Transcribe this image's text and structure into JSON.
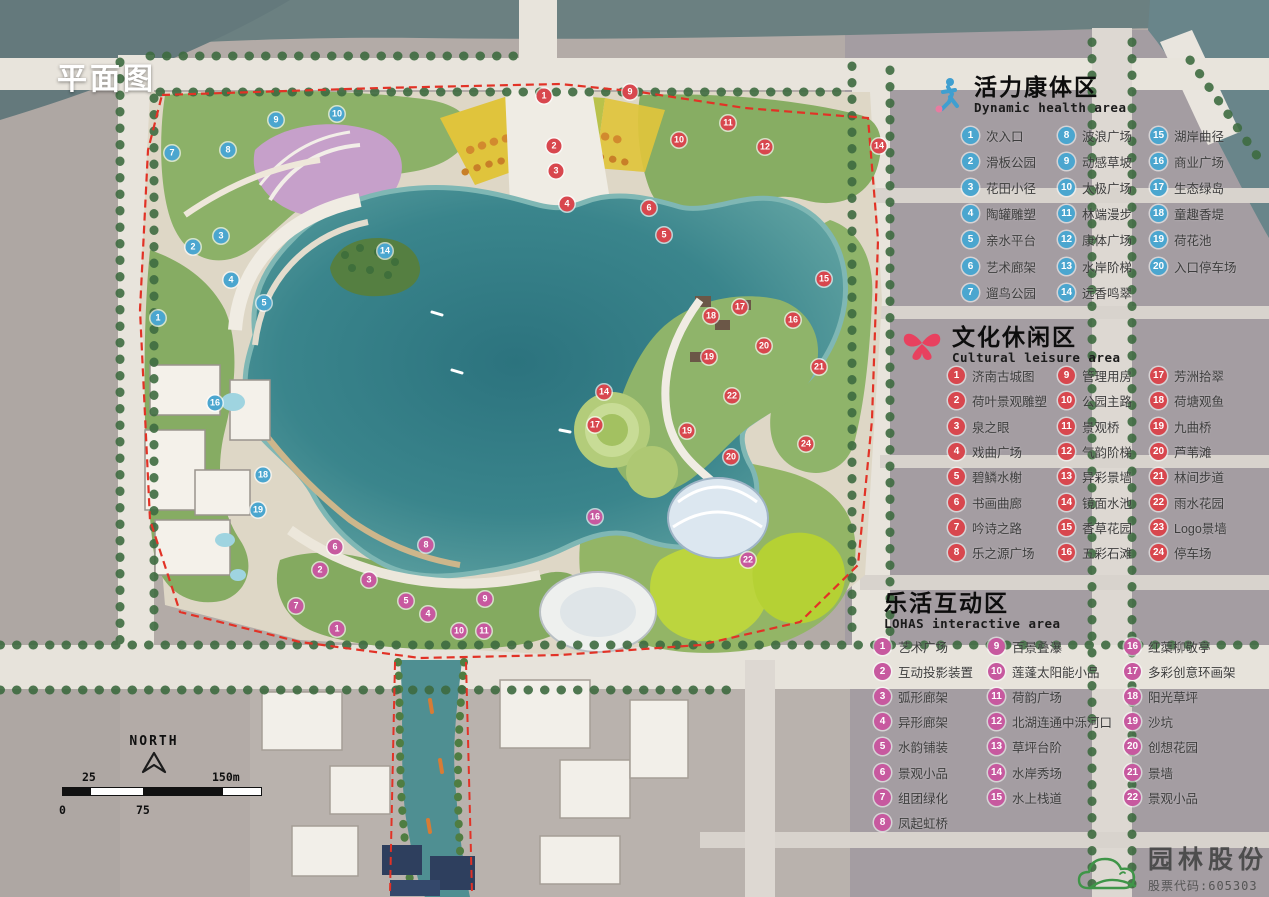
{
  "title": "平面图",
  "north_label": "NORTH",
  "scale_bar": {
    "top_labels": [
      "25",
      "150m"
    ],
    "bottom_labels": [
      "0",
      "75"
    ]
  },
  "logo": {
    "company": "园林股份",
    "ticker": "股票代码:605303",
    "icon": "cloud-hill-logo-icon",
    "color": "#3f9548"
  },
  "zones": [
    {
      "id": "dynamic",
      "cn": "活力康体区",
      "en": "Dynamic health area",
      "icon": "runner-icon",
      "badge_color": "#4ba6cf",
      "columns": [
        [
          {
            "n": "1",
            "t": "次入口"
          },
          {
            "n": "2",
            "t": "滑板公园"
          },
          {
            "n": "3",
            "t": "花田小径"
          },
          {
            "n": "4",
            "t": "陶罐雕塑"
          },
          {
            "n": "5",
            "t": "亲水平台"
          },
          {
            "n": "6",
            "t": "艺术廊架"
          },
          {
            "n": "7",
            "t": "遛鸟公园"
          }
        ],
        [
          {
            "n": "8",
            "t": "波浪广场"
          },
          {
            "n": "9",
            "t": "动感草坡"
          },
          {
            "n": "10",
            "t": "太极广场"
          },
          {
            "n": "11",
            "t": "林端漫步"
          },
          {
            "n": "12",
            "t": "康体广场"
          },
          {
            "n": "13",
            "t": "水岸阶梯"
          },
          {
            "n": "14",
            "t": "远香鸣翠"
          }
        ],
        [
          {
            "n": "15",
            "t": "湖岸曲径"
          },
          {
            "n": "16",
            "t": "商业广场"
          },
          {
            "n": "17",
            "t": "生态绿岛"
          },
          {
            "n": "18",
            "t": "童趣香堤"
          },
          {
            "n": "19",
            "t": "荷花池"
          },
          {
            "n": "20",
            "t": "入口停车场"
          }
        ]
      ]
    },
    {
      "id": "cultural",
      "cn": "文化休闲区",
      "en": "Cultural leisure area",
      "icon": "butterfly-icon",
      "badge_color": "#d8474e",
      "columns": [
        [
          {
            "n": "1",
            "t": "济南古城图"
          },
          {
            "n": "2",
            "t": "荷叶景观雕塑"
          },
          {
            "n": "3",
            "t": "泉之眼"
          },
          {
            "n": "4",
            "t": "戏曲广场"
          },
          {
            "n": "5",
            "t": "碧鳞水榭"
          },
          {
            "n": "6",
            "t": "书画曲廊"
          },
          {
            "n": "7",
            "t": "吟诗之路"
          },
          {
            "n": "8",
            "t": "乐之源广场"
          }
        ],
        [
          {
            "n": "9",
            "t": "管理用房"
          },
          {
            "n": "10",
            "t": "公园主路"
          },
          {
            "n": "11",
            "t": "景观桥"
          },
          {
            "n": "12",
            "t": "气韵阶梯"
          },
          {
            "n": "13",
            "t": "异彩景墙"
          },
          {
            "n": "14",
            "t": "镜面水池"
          },
          {
            "n": "15",
            "t": "香草花园"
          },
          {
            "n": "16",
            "t": "五彩石滩"
          }
        ],
        [
          {
            "n": "17",
            "t": "芳洲拾翠"
          },
          {
            "n": "18",
            "t": "荷塘观鱼"
          },
          {
            "n": "19",
            "t": "九曲桥"
          },
          {
            "n": "20",
            "t": "芦苇滩"
          },
          {
            "n": "21",
            "t": "林间步道"
          },
          {
            "n": "22",
            "t": "雨水花园"
          },
          {
            "n": "23",
            "t": "Logo景墙"
          },
          {
            "n": "24",
            "t": "停车场"
          }
        ]
      ]
    },
    {
      "id": "lohas",
      "cn": "乐活互动区",
      "en": "LOHAS interactive area",
      "icon": "crescent-moon-icon",
      "badge_color": "#c7599f",
      "columns": [
        [
          {
            "n": "1",
            "t": "艺术广场"
          },
          {
            "n": "2",
            "t": "互动投影装置"
          },
          {
            "n": "3",
            "t": "弧形廊架"
          },
          {
            "n": "4",
            "t": "异形廊架"
          },
          {
            "n": "5",
            "t": "水韵铺装"
          },
          {
            "n": "6",
            "t": "景观小品"
          },
          {
            "n": "7",
            "t": "组团绿化"
          },
          {
            "n": "8",
            "t": "凤起虹桥"
          }
        ],
        [
          {
            "n": "9",
            "t": "百景叠瀑"
          },
          {
            "n": "10",
            "t": "莲蓬太阳能小品"
          },
          {
            "n": "11",
            "t": "荷韵广场"
          },
          {
            "n": "12",
            "t": "北湖连通中泺河口"
          },
          {
            "n": "13",
            "t": "草坪台阶"
          },
          {
            "n": "14",
            "t": "水岸秀场"
          },
          {
            "n": "15",
            "t": "水上栈道"
          }
        ],
        [
          {
            "n": "16",
            "t": "红蕖柳敬亭"
          },
          {
            "n": "17",
            "t": "多彩创意环画架"
          },
          {
            "n": "18",
            "t": "阳光草坪"
          },
          {
            "n": "19",
            "t": "沙坑"
          },
          {
            "n": "20",
            "t": "创想花园"
          },
          {
            "n": "21",
            "t": "景墙"
          },
          {
            "n": "22",
            "t": "景观小品"
          }
        ]
      ]
    }
  ],
  "map_markers": [
    {
      "zone": "dynamic",
      "n": "1",
      "x": 158,
      "y": 318
    },
    {
      "zone": "dynamic",
      "n": "2",
      "x": 193,
      "y": 247
    },
    {
      "zone": "dynamic",
      "n": "3",
      "x": 221,
      "y": 236
    },
    {
      "zone": "dynamic",
      "n": "4",
      "x": 231,
      "y": 280
    },
    {
      "zone": "dynamic",
      "n": "5",
      "x": 264,
      "y": 303
    },
    {
      "zone": "dynamic",
      "n": "7",
      "x": 172,
      "y": 153
    },
    {
      "zone": "dynamic",
      "n": "8",
      "x": 228,
      "y": 150
    },
    {
      "zone": "dynamic",
      "n": "9",
      "x": 276,
      "y": 120
    },
    {
      "zone": "dynamic",
      "n": "10",
      "x": 337,
      "y": 114
    },
    {
      "zone": "dynamic",
      "n": "14",
      "x": 385,
      "y": 251
    },
    {
      "zone": "dynamic",
      "n": "16",
      "x": 215,
      "y": 403
    },
    {
      "zone": "dynamic",
      "n": "18",
      "x": 263,
      "y": 475
    },
    {
      "zone": "dynamic",
      "n": "19",
      "x": 258,
      "y": 510
    },
    {
      "zone": "cultural",
      "n": "1",
      "x": 544,
      "y": 96
    },
    {
      "zone": "cultural",
      "n": "2",
      "x": 554,
      "y": 146
    },
    {
      "zone": "cultural",
      "n": "3",
      "x": 556,
      "y": 171
    },
    {
      "zone": "cultural",
      "n": "4",
      "x": 567,
      "y": 204
    },
    {
      "zone": "cultural",
      "n": "5",
      "x": 664,
      "y": 235
    },
    {
      "zone": "cultural",
      "n": "6",
      "x": 649,
      "y": 208
    },
    {
      "zone": "cultural",
      "n": "9",
      "x": 630,
      "y": 92
    },
    {
      "zone": "cultural",
      "n": "10",
      "x": 679,
      "y": 140
    },
    {
      "zone": "cultural",
      "n": "11",
      "x": 728,
      "y": 123
    },
    {
      "zone": "cultural",
      "n": "12",
      "x": 765,
      "y": 147
    },
    {
      "zone": "cultural",
      "n": "14",
      "x": 879,
      "y": 146
    },
    {
      "zone": "cultural",
      "n": "15",
      "x": 824,
      "y": 279
    },
    {
      "zone": "cultural",
      "n": "16",
      "x": 793,
      "y": 320
    },
    {
      "zone": "cultural",
      "n": "17",
      "x": 740,
      "y": 307
    },
    {
      "zone": "cultural",
      "n": "18",
      "x": 711,
      "y": 316
    },
    {
      "zone": "cultural",
      "n": "19",
      "x": 709,
      "y": 357
    },
    {
      "zone": "cultural",
      "n": "20",
      "x": 764,
      "y": 346
    },
    {
      "zone": "cultural",
      "n": "21",
      "x": 819,
      "y": 367
    },
    {
      "zone": "cultural",
      "n": "22",
      "x": 732,
      "y": 396
    },
    {
      "zone": "cultural",
      "n": "24",
      "x": 806,
      "y": 444
    },
    {
      "zone": "cultural",
      "n": "14",
      "x": 604,
      "y": 392
    },
    {
      "zone": "cultural",
      "n": "17",
      "x": 595,
      "y": 425
    },
    {
      "zone": "cultural",
      "n": "19",
      "x": 687,
      "y": 431
    },
    {
      "zone": "cultural",
      "n": "20",
      "x": 731,
      "y": 457
    },
    {
      "zone": "lohas",
      "n": "1",
      "x": 337,
      "y": 629
    },
    {
      "zone": "lohas",
      "n": "2",
      "x": 320,
      "y": 570
    },
    {
      "zone": "lohas",
      "n": "3",
      "x": 369,
      "y": 580
    },
    {
      "zone": "lohas",
      "n": "4",
      "x": 428,
      "y": 614
    },
    {
      "zone": "lohas",
      "n": "5",
      "x": 406,
      "y": 601
    },
    {
      "zone": "lohas",
      "n": "6",
      "x": 335,
      "y": 547
    },
    {
      "zone": "lohas",
      "n": "7",
      "x": 296,
      "y": 606
    },
    {
      "zone": "lohas",
      "n": "8",
      "x": 426,
      "y": 545
    },
    {
      "zone": "lohas",
      "n": "9",
      "x": 485,
      "y": 599
    },
    {
      "zone": "lohas",
      "n": "10",
      "x": 459,
      "y": 631
    },
    {
      "zone": "lohas",
      "n": "11",
      "x": 484,
      "y": 631
    },
    {
      "zone": "lohas",
      "n": "16",
      "x": 595,
      "y": 517
    },
    {
      "zone": "lohas",
      "n": "22",
      "x": 748,
      "y": 560
    }
  ]
}
